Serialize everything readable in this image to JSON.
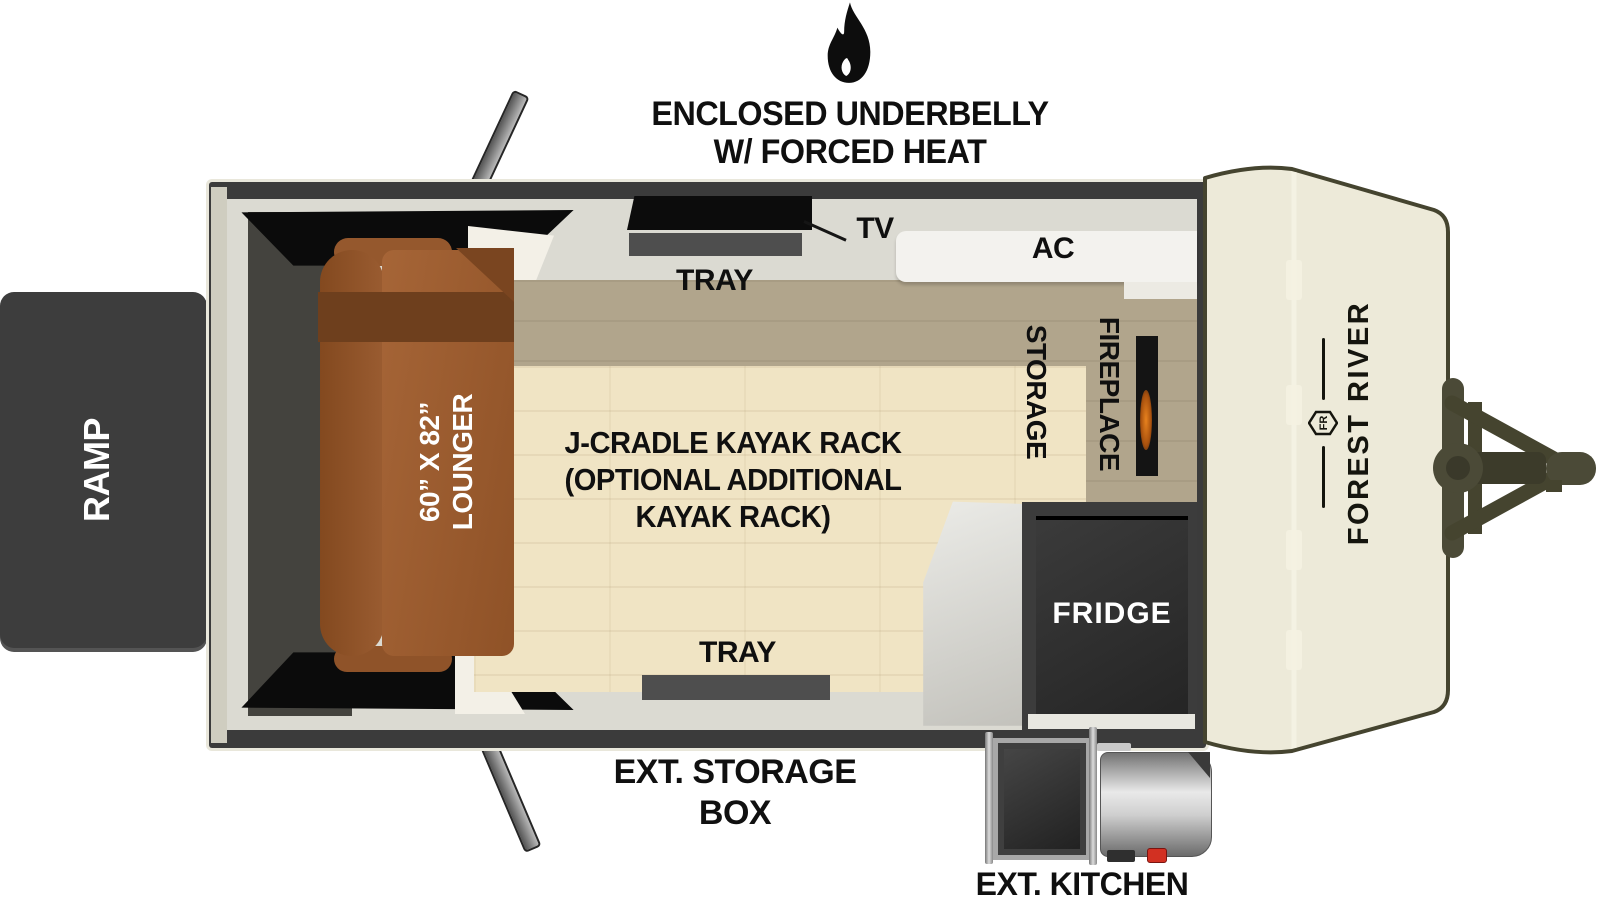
{
  "header": {
    "icon": "flame-icon",
    "title_line1": "ENCLOSED UNDERBELLY",
    "title_line2": "W/ FORCED HEAT"
  },
  "floorplan": {
    "ramp_label": "RAMP",
    "lounger": {
      "size": "60” X 82”",
      "name": "LOUNGER"
    },
    "kayak_note": {
      "line1": "J-CRADLE KAYAK RACK",
      "line2": "(OPTIONAL ADDITIONAL",
      "line3": "KAYAK RACK)"
    },
    "tv_label": "TV",
    "tray_top_label": "TRAY",
    "tray_bottom_label": "TRAY",
    "ac_label": "AC",
    "storage_label": "STORAGE",
    "fireplace_label": "FIREPLACE",
    "fridge_label": "FRIDGE"
  },
  "exterior": {
    "storage_box_line1": "EXT. STORAGE",
    "storage_box_line2": "BOX",
    "kitchen_label": "EXT. KITCHEN"
  },
  "brand": {
    "name": "FOREST RIVER",
    "monogram": "FR",
    "logo": "fr-monogram"
  },
  "colors": {
    "wall": "#3b3b3b",
    "walkway": "#dbdad2",
    "floor_light": "#f0e4c4",
    "floor_shadow": "#b1a58c",
    "lounger_brown": "#9a5c31",
    "ramp_gray": "#3d3d3d",
    "front_cap_cream": "#edead9",
    "hitch_olive": "#4b4a37",
    "fridge_dark": "#2e2e2e",
    "flame_accent": "#e8821e",
    "knob_red": "#d23022"
  }
}
